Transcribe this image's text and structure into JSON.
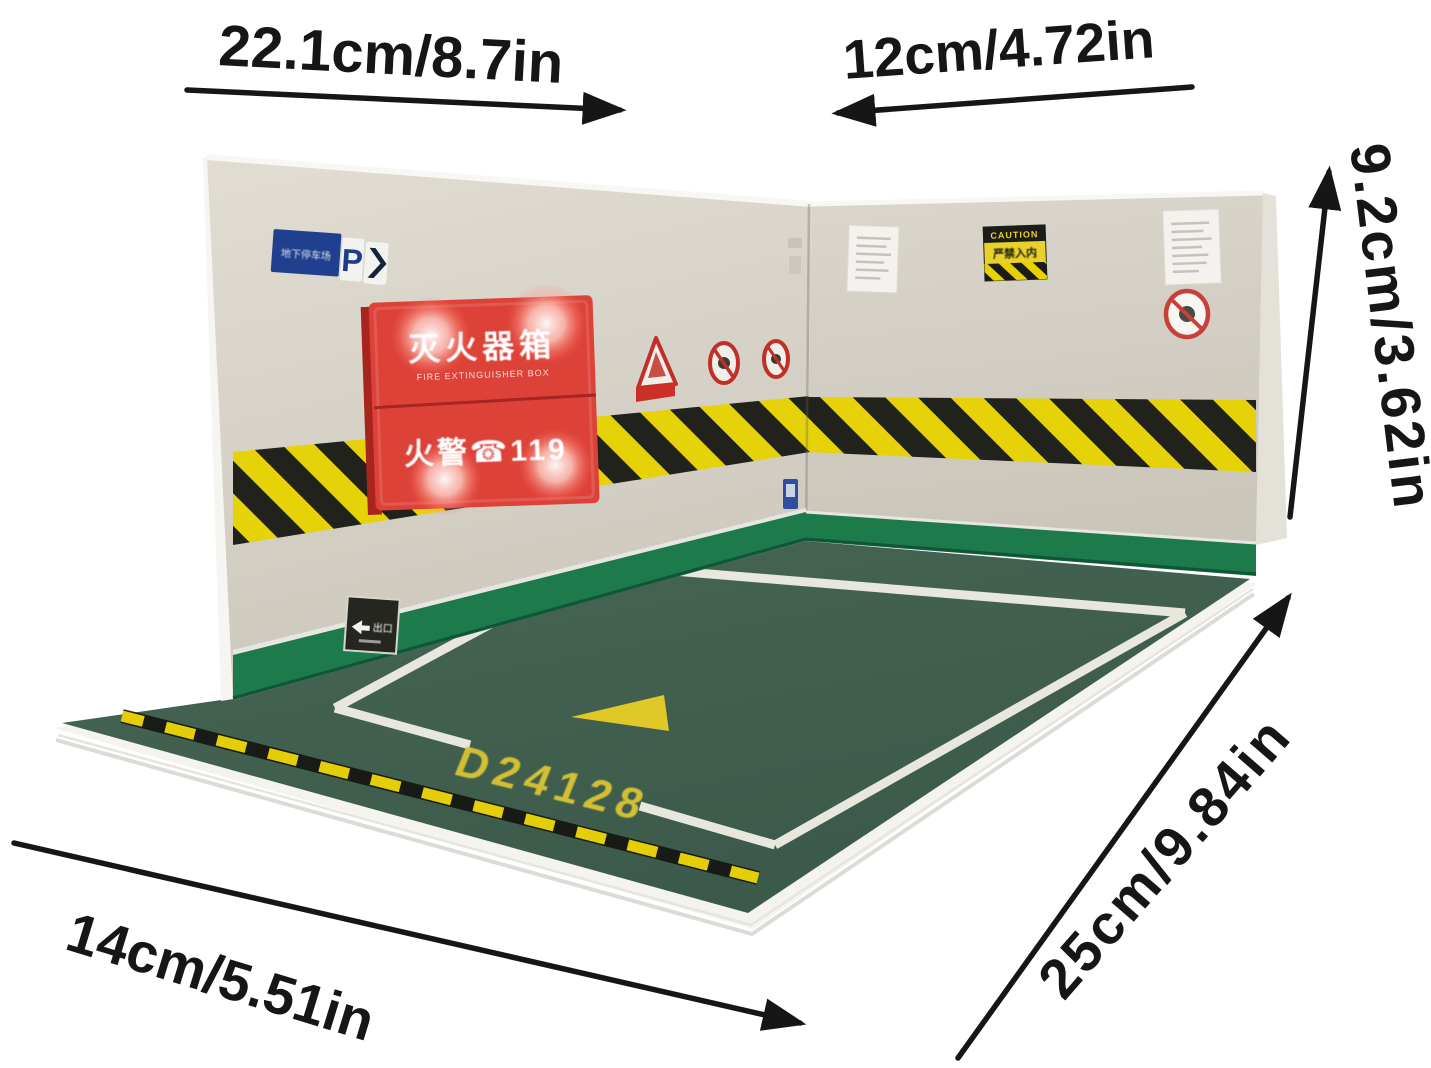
{
  "page": {
    "background": "#ffffff",
    "subject": "parking-garage-diorama-product-photo"
  },
  "annotations": {
    "top_width": "22.1cm/8.7in",
    "back_width": "12cm/4.72in",
    "wall_height": "9.2cm/3.62in",
    "depth": "25cm/9.84in",
    "front_width": "14cm/5.51in"
  },
  "model": {
    "parking_sign": {
      "location_text": "地下停车场",
      "p": "P"
    },
    "fire_extinguisher_box": {
      "title": "灭火器箱",
      "subtitle": "FIRE EXTINGUISHER BOX",
      "alarm_text": "火警☎119"
    },
    "caution_sign": {
      "header": "CAUTION",
      "body": "严禁入内"
    },
    "exit_sign": {
      "label": "出口"
    },
    "floor_space_code": "D24128",
    "colors": {
      "floor_green": "#42614f",
      "baseboard_green": "#1d7a4a",
      "wall_beige": "#d7d2c8",
      "hazard_yellow": "#e6d200",
      "hazard_black": "#1b1b15",
      "firebox_red": "#dd4238",
      "marking_yellow": "#e2c930",
      "parking_sign_blue": "#20408f"
    }
  }
}
